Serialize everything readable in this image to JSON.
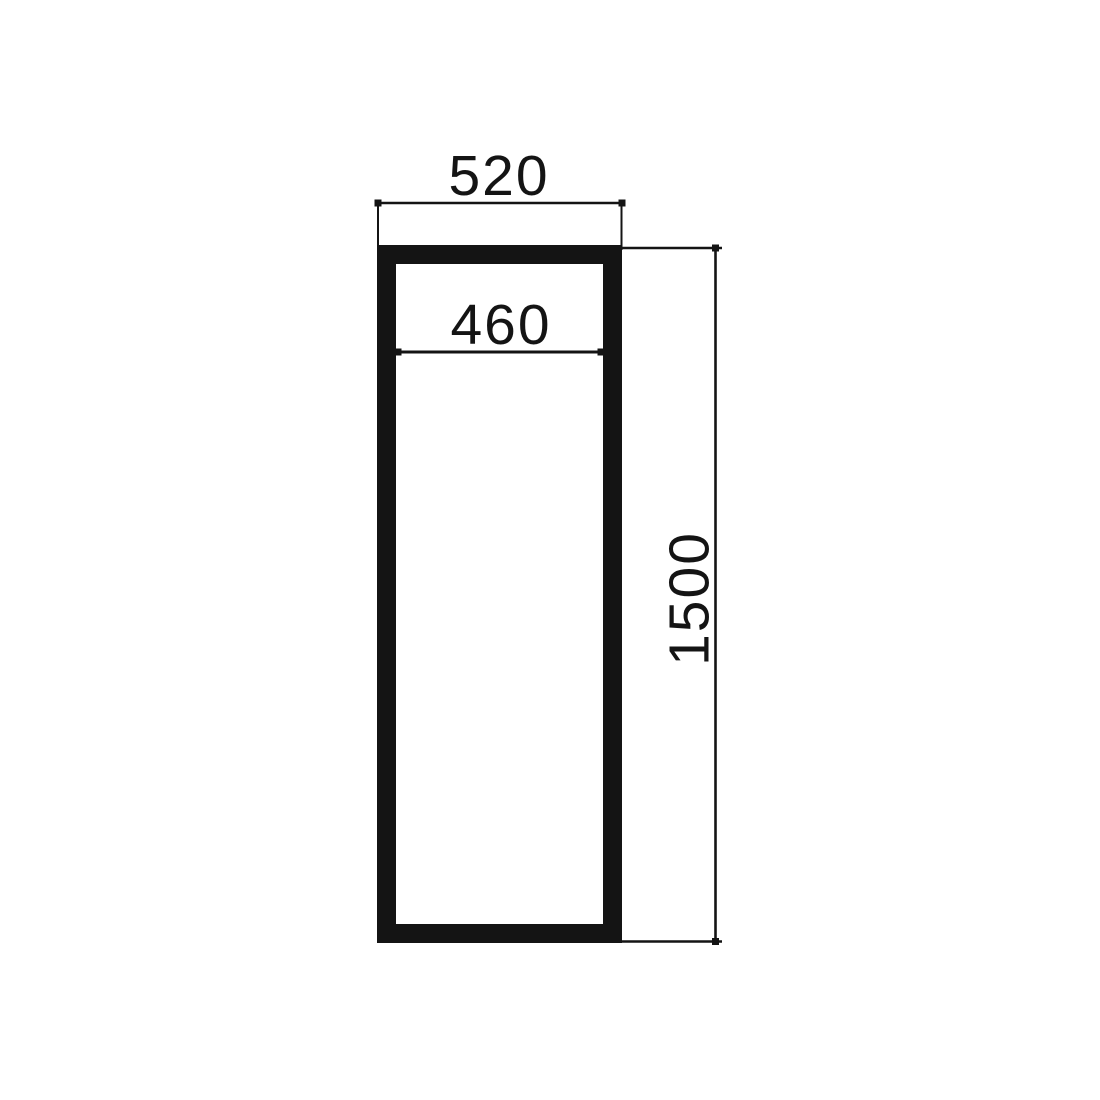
{
  "colors": {
    "line": "#141414",
    "background": "#ffffff"
  },
  "drawing": {
    "kind": "technical dimension drawing",
    "subject": "tall rectangular frame, front elevation",
    "labels": {
      "top_width": "520",
      "inner_width": "460",
      "height": "1500"
    }
  }
}
